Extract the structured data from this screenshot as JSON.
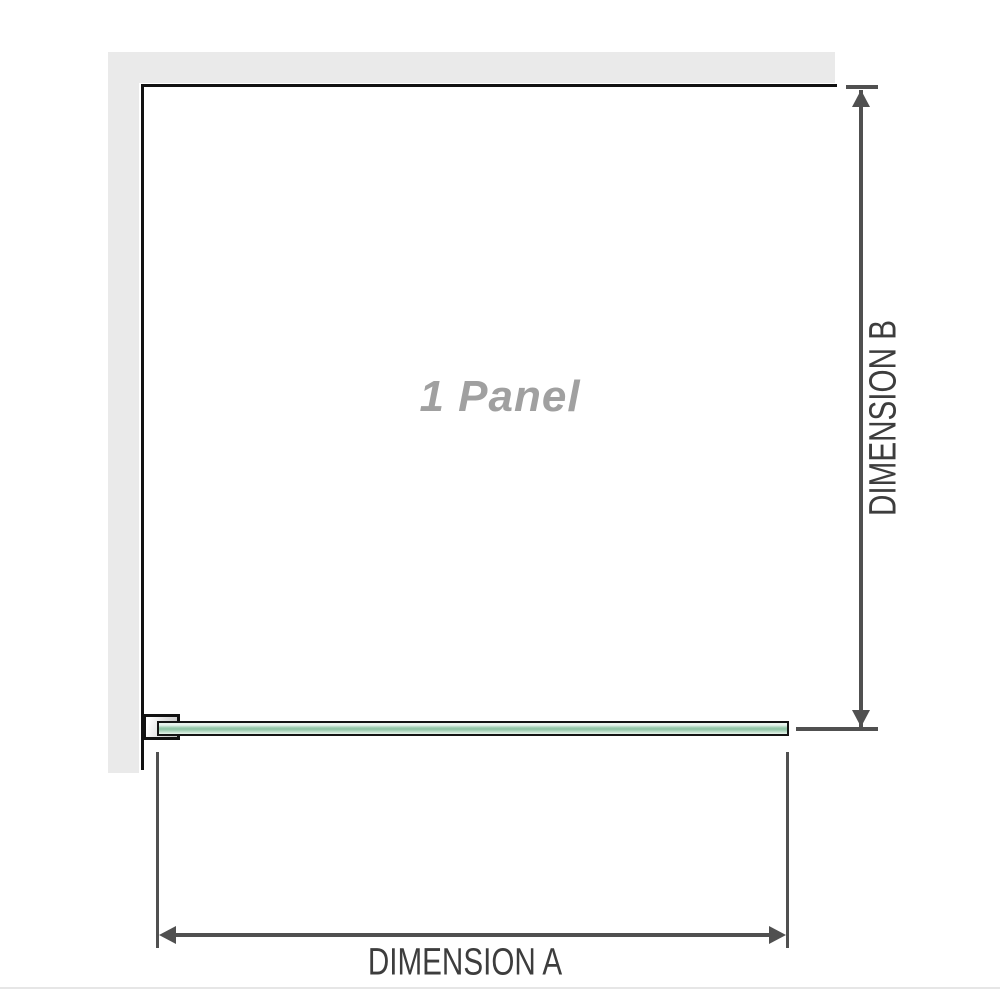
{
  "diagram": {
    "panel_label": "1 Panel",
    "dimension_a_label": "DIMENSION A",
    "dimension_b_label": "DIMENSION B"
  },
  "colors": {
    "wall_gray": "#eaeaea",
    "line_black": "#111111",
    "dim_gray": "#505050",
    "text_dark": "#3d3d3d",
    "label_gray": "#a0a0a0",
    "glass_top": "#e8f4ed",
    "glass_mid": "#93c6a8",
    "glass_bottom": "#c3e1cf"
  }
}
